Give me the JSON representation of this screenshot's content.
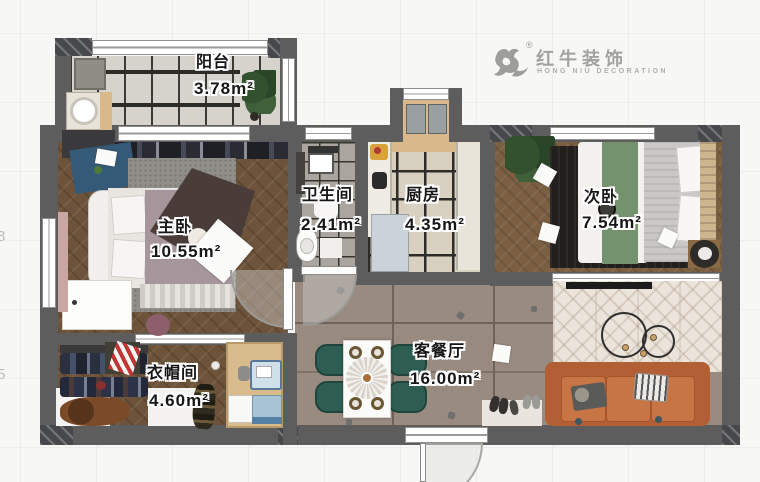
{
  "logo": {
    "brand": "红牛装饰",
    "subtitle": "HONG NIU DECORATION",
    "registered": "®"
  },
  "ruler": {
    "marks": [
      {
        "label": "8"
      },
      {
        "label": "5"
      }
    ]
  },
  "rooms": [
    {
      "id": "balcony",
      "name": "阳台",
      "area": "3.78m²"
    },
    {
      "id": "master-bedroom",
      "name": "主卧",
      "area": "10.55m²"
    },
    {
      "id": "bathroom",
      "name": "卫生间",
      "area": "2.41m²"
    },
    {
      "id": "kitchen",
      "name": "厨房",
      "area": "4.35m²"
    },
    {
      "id": "second-bedroom",
      "name": "次卧",
      "area": "7.54m²"
    },
    {
      "id": "cloakroom",
      "name": "衣帽间",
      "area": "4.60m²"
    },
    {
      "id": "living-dining",
      "name": "客餐厅",
      "area": "16.00m²"
    }
  ],
  "colors": {
    "wall": "#5d5d5d",
    "wood_floor": "#6d5339",
    "living_tile": "#998b80",
    "kitchen_tile": "#d8d1c2",
    "bathroom_tile": "#aaa69f",
    "sofa_orange": "#c06a3e",
    "chair_green": "#2e5e52",
    "bed_runner_green": "#75926f",
    "logo_gray": "#a2a2a0"
  }
}
